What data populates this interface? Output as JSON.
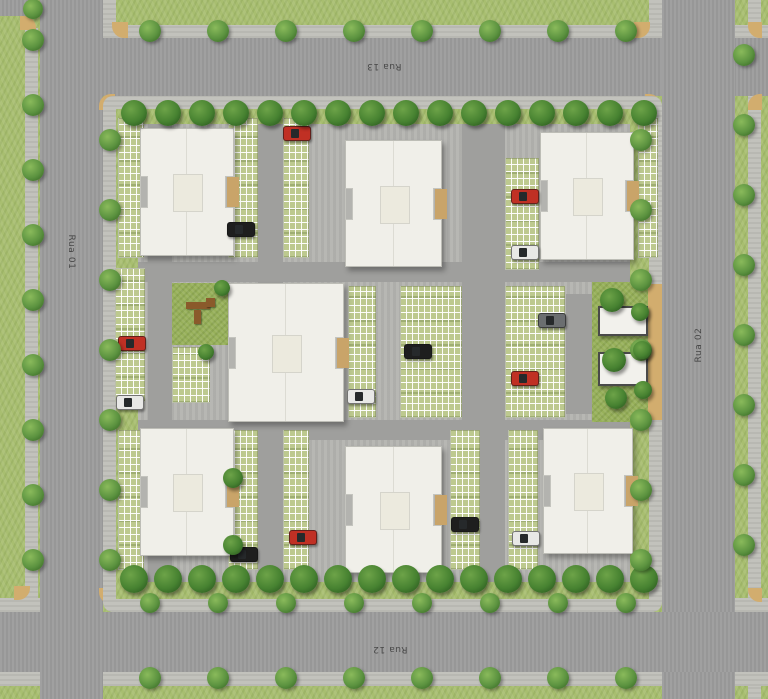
{
  "canvas": {
    "width": 768,
    "height": 699
  },
  "palette": {
    "grass": "#a8be70",
    "asphalt": "#9c9c9c",
    "sidewalk": "#c2c2bc",
    "curb_tan": "#d2ad6e",
    "building": "#f0efe9",
    "parking_green": "#bdc98f",
    "tree_dark": "#2f5f22",
    "tree_light": "#5c9340",
    "car_red": "#c03024",
    "car_black": "#1e1e1e",
    "car_white": "#e8e8e6",
    "car_gray": "#6b6e70"
  },
  "street_labels": [
    {
      "text": "Rua 13",
      "x": 384,
      "y": 66,
      "rot": 180
    },
    {
      "text": "Rua 12",
      "x": 390,
      "y": 649,
      "rot": 180
    },
    {
      "text": "Rua 01",
      "x": 71,
      "y": 252,
      "rot": 90
    },
    {
      "text": "Rua 02",
      "x": 699,
      "y": 345,
      "rot": -90
    }
  ],
  "ground": [
    {
      "name": "grass-base",
      "cls": "grass",
      "x": 0,
      "y": 0,
      "w": 768,
      "h": 699
    },
    {
      "name": "sidewalk-west-verge",
      "cls": "walk",
      "x": 25,
      "y": 28,
      "w": 13,
      "h": 570
    },
    {
      "name": "sidewalk-far-east",
      "cls": "walk",
      "x": 748,
      "y": 0,
      "w": 13,
      "h": 699
    },
    {
      "name": "sidewalk-rua13-north",
      "cls": "walk",
      "x": 40,
      "y": 25,
      "w": 728,
      "h": 13
    },
    {
      "name": "sidewalk-rua02-top",
      "cls": "walk",
      "x": 649,
      "y": 0,
      "w": 13,
      "h": 25
    },
    {
      "name": "sidewalk-rua01-top",
      "cls": "walk",
      "x": 103,
      "y": 0,
      "w": 13,
      "h": 25
    },
    {
      "name": "sidewalk-rua12-south",
      "cls": "walk",
      "x": 0,
      "y": 672,
      "w": 768,
      "h": 14
    },
    {
      "name": "sidewalk-rua12-north-w",
      "cls": "walk",
      "x": 0,
      "y": 598,
      "w": 40,
      "h": 14
    },
    {
      "name": "sidewalk-rua12-north-e",
      "cls": "walk",
      "x": 735,
      "y": 598,
      "w": 33,
      "h": 14
    },
    {
      "name": "road-rua-13",
      "cls": "road",
      "x": 40,
      "y": 38,
      "w": 728,
      "h": 58
    },
    {
      "name": "road-rua-01",
      "cls": "road",
      "x": 40,
      "y": 0,
      "w": 63,
      "h": 699
    },
    {
      "name": "road-rua-02",
      "cls": "road",
      "x": 662,
      "y": 0,
      "w": 73,
      "h": 699
    },
    {
      "name": "road-rua-12",
      "cls": "road",
      "x": 0,
      "y": 612,
      "w": 768,
      "h": 60
    },
    {
      "name": "road-stub-top-left",
      "cls": "road",
      "x": 0,
      "y": 0,
      "w": 34,
      "h": 16
    },
    {
      "name": "curb-corner",
      "cls": "tan",
      "x": 99,
      "y": 94,
      "w": 16,
      "h": 16,
      "br": "12px 0 0 0"
    },
    {
      "name": "curb-corner",
      "cls": "tan",
      "x": 645,
      "y": 94,
      "w": 16,
      "h": 16,
      "br": "0 12px 0 0"
    },
    {
      "name": "curb-corner",
      "cls": "tan",
      "x": 99,
      "y": 588,
      "w": 16,
      "h": 16,
      "br": "0 0 0 12px"
    },
    {
      "name": "curb-corner",
      "cls": "tan",
      "x": 645,
      "y": 588,
      "w": 16,
      "h": 16,
      "br": "0 0 12px 0"
    },
    {
      "name": "curb-corner",
      "cls": "tan",
      "x": 112,
      "y": 22,
      "w": 16,
      "h": 16,
      "br": "0 0 0 12px"
    },
    {
      "name": "curb-corner",
      "cls": "tan",
      "x": 634,
      "y": 22,
      "w": 16,
      "h": 16,
      "br": "0 0 12px 0"
    },
    {
      "name": "curb-corner",
      "cls": "tan",
      "x": 748,
      "y": 22,
      "w": 14,
      "h": 16,
      "br": "0 0 0 12px"
    },
    {
      "name": "curb-corner",
      "cls": "tan",
      "x": 748,
      "y": 94,
      "w": 14,
      "h": 16,
      "br": "12px 0 0 0"
    },
    {
      "name": "curb-corner",
      "cls": "tan",
      "x": 20,
      "y": 16,
      "w": 16,
      "h": 14,
      "br": "0 12px 0 0"
    },
    {
      "name": "curb-corner",
      "cls": "tan",
      "x": 14,
      "y": 586,
      "w": 16,
      "h": 14,
      "br": "0 0 12px 0"
    },
    {
      "name": "curb-corner",
      "cls": "tan",
      "x": 748,
      "y": 588,
      "w": 14,
      "h": 14,
      "br": "0 0 0 12px"
    },
    {
      "name": "block-sidewalk-ring",
      "cls": "walk",
      "x": 103,
      "y": 96,
      "w": 559,
      "h": 516,
      "br": "10px"
    },
    {
      "name": "block-lawn-ring",
      "cls": "lawn",
      "x": 116,
      "y": 109,
      "w": 533,
      "h": 490
    },
    {
      "name": "block-interior-paving",
      "cls": "pave",
      "x": 138,
      "y": 124,
      "w": 492,
      "h": 458
    },
    {
      "name": "internal-road-north",
      "cls": "iroad",
      "x": 138,
      "y": 262,
      "w": 492,
      "h": 20
    },
    {
      "name": "internal-road-south",
      "cls": "iroad",
      "x": 138,
      "y": 420,
      "w": 492,
      "h": 20
    },
    {
      "name": "internal-road-west",
      "cls": "iroad",
      "x": 148,
      "y": 124,
      "w": 24,
      "h": 458
    },
    {
      "name": "internal-road-mid-left",
      "cls": "iroad",
      "x": 258,
      "y": 124,
      "w": 25,
      "h": 458
    },
    {
      "name": "internal-road-mid-right",
      "cls": "iroad",
      "x": 462,
      "y": 124,
      "w": 43,
      "h": 458
    },
    {
      "name": "entrance-lane-in",
      "cls": "iroad",
      "x": 570,
      "y": 294,
      "w": 78,
      "h": 26
    },
    {
      "name": "entrance-lane-out",
      "cls": "iroad",
      "x": 570,
      "y": 388,
      "w": 78,
      "h": 26
    },
    {
      "name": "entrance-lane-link",
      "cls": "iroad",
      "x": 566,
      "y": 294,
      "w": 26,
      "h": 120
    },
    {
      "name": "entrance-driveway-tan",
      "cls": "tan",
      "x": 646,
      "y": 284,
      "w": 16,
      "h": 136
    },
    {
      "name": "entrance-lawn",
      "cls": "lawn2",
      "x": 592,
      "y": 282,
      "w": 56,
      "h": 140
    },
    {
      "name": "playground-lawn",
      "cls": "lawn2",
      "x": 172,
      "y": 283,
      "w": 56,
      "h": 62
    },
    {
      "name": "playground-equipment",
      "cls": "equip",
      "x": 186,
      "y": 302,
      "w": 24,
      "h": 7
    },
    {
      "name": "playground-equipment",
      "cls": "equip",
      "x": 194,
      "y": 310,
      "w": 7,
      "h": 14
    },
    {
      "name": "playground-equipment",
      "cls": "equip",
      "x": 206,
      "y": 298,
      "w": 9,
      "h": 9
    },
    {
      "name": "hedge",
      "cls": "hedge",
      "x": 230,
      "y": 334,
      "w": 11,
      "h": 13
    },
    {
      "name": "hedge",
      "cls": "hedge",
      "x": 345,
      "y": 338,
      "w": 8,
      "h": 12
    }
  ],
  "parking_lots": [
    {
      "x": 118,
      "y": 118,
      "w": 26,
      "h": 140
    },
    {
      "x": 228,
      "y": 118,
      "w": 30,
      "h": 140
    },
    {
      "x": 283,
      "y": 118,
      "w": 26,
      "h": 140
    },
    {
      "x": 505,
      "y": 158,
      "w": 34,
      "h": 112
    },
    {
      "x": 638,
      "y": 118,
      "w": 20,
      "h": 140
    },
    {
      "x": 115,
      "y": 268,
      "w": 30,
      "h": 134
    },
    {
      "x": 172,
      "y": 347,
      "w": 38,
      "h": 56
    },
    {
      "x": 348,
      "y": 286,
      "w": 28,
      "h": 132
    },
    {
      "x": 400,
      "y": 286,
      "w": 62,
      "h": 132
    },
    {
      "x": 505,
      "y": 286,
      "w": 60,
      "h": 132
    },
    {
      "x": 118,
      "y": 430,
      "w": 26,
      "h": 140
    },
    {
      "x": 228,
      "y": 430,
      "w": 30,
      "h": 140
    },
    {
      "x": 283,
      "y": 430,
      "w": 26,
      "h": 140
    },
    {
      "x": 450,
      "y": 430,
      "w": 30,
      "h": 140
    },
    {
      "x": 508,
      "y": 430,
      "w": 30,
      "h": 140
    }
  ],
  "buildings": [
    {
      "name": "building-top-left",
      "x": 140,
      "y": 128,
      "w": 92,
      "h": 126
    },
    {
      "name": "building-top-center",
      "x": 345,
      "y": 140,
      "w": 95,
      "h": 125
    },
    {
      "name": "building-top-right",
      "x": 540,
      "y": 132,
      "w": 92,
      "h": 126
    },
    {
      "name": "building-center",
      "x": 228,
      "y": 283,
      "w": 114,
      "h": 137
    },
    {
      "name": "building-bottom-left",
      "x": 140,
      "y": 428,
      "w": 92,
      "h": 126
    },
    {
      "name": "building-bottom-center",
      "x": 345,
      "y": 446,
      "w": 95,
      "h": 125
    },
    {
      "name": "building-bottom-right",
      "x": 543,
      "y": 428,
      "w": 88,
      "h": 124
    }
  ],
  "structures": [
    {
      "name": "gatehouse",
      "x": 598,
      "y": 306,
      "w": 46,
      "h": 26
    },
    {
      "name": "gate-carport",
      "x": 598,
      "y": 352,
      "w": 46,
      "h": 30
    }
  ],
  "cars": [
    {
      "x": 283,
      "y": 126,
      "color": "#c03024"
    },
    {
      "x": 227,
      "y": 222,
      "color": "#1e1e1e"
    },
    {
      "x": 511,
      "y": 189,
      "color": "#c03024"
    },
    {
      "x": 511,
      "y": 245,
      "color": "#e8e8e6"
    },
    {
      "x": 118,
      "y": 336,
      "color": "#c03024"
    },
    {
      "x": 116,
      "y": 395,
      "color": "#e8e8e6"
    },
    {
      "x": 347,
      "y": 389,
      "color": "#e8e8e6"
    },
    {
      "x": 404,
      "y": 344,
      "color": "#1e1e1e"
    },
    {
      "x": 538,
      "y": 313,
      "color": "#6b6e70"
    },
    {
      "x": 511,
      "y": 371,
      "color": "#c03024"
    },
    {
      "x": 289,
      "y": 530,
      "color": "#c03024"
    },
    {
      "x": 230,
      "y": 547,
      "color": "#1e1e1e"
    },
    {
      "x": 451,
      "y": 517,
      "color": "#1e1e1e"
    },
    {
      "x": 512,
      "y": 531,
      "color": "#e8e8e6"
    }
  ],
  "tree_rows": [
    {
      "x": 150,
      "y": 31,
      "dx": 68,
      "dy": 0,
      "n": 8,
      "r": 11,
      "kind": "street"
    },
    {
      "x": 33,
      "y": 9,
      "dx": 0,
      "dy": 0,
      "n": 1,
      "r": 10,
      "kind": "street"
    },
    {
      "x": 134,
      "y": 113,
      "dx": 34,
      "dy": 0,
      "n": 16,
      "r": 13,
      "kind": "dense"
    },
    {
      "x": 134,
      "y": 579,
      "dx": 34,
      "dy": 0,
      "n": 16,
      "r": 14,
      "kind": "dense"
    },
    {
      "x": 150,
      "y": 603,
      "dx": 68,
      "dy": 0,
      "n": 8,
      "r": 10,
      "kind": "street"
    },
    {
      "x": 150,
      "y": 678,
      "dx": 68,
      "dy": 0,
      "n": 8,
      "r": 11,
      "kind": "street"
    },
    {
      "x": 33,
      "y": 40,
      "dx": 0,
      "dy": 65,
      "n": 9,
      "r": 11,
      "kind": "street"
    },
    {
      "x": 110,
      "y": 140,
      "dx": 0,
      "dy": 70,
      "n": 7,
      "r": 11,
      "kind": "street"
    },
    {
      "x": 641,
      "y": 140,
      "dx": 0,
      "dy": 70,
      "n": 7,
      "r": 11,
      "kind": "street"
    },
    {
      "x": 744,
      "y": 55,
      "dx": 0,
      "dy": 70,
      "n": 8,
      "r": 11,
      "kind": "street"
    }
  ],
  "single_trees": [
    {
      "x": 612,
      "y": 300,
      "r": 12,
      "kind": "dense"
    },
    {
      "x": 640,
      "y": 312,
      "r": 9,
      "kind": "dense"
    },
    {
      "x": 614,
      "y": 360,
      "r": 12,
      "kind": "dense"
    },
    {
      "x": 642,
      "y": 350,
      "r": 9,
      "kind": "dense"
    },
    {
      "x": 616,
      "y": 398,
      "r": 11,
      "kind": "dense"
    },
    {
      "x": 643,
      "y": 390,
      "r": 9,
      "kind": "dense"
    },
    {
      "x": 222,
      "y": 288,
      "r": 8,
      "kind": "dense"
    },
    {
      "x": 233,
      "y": 478,
      "r": 10,
      "kind": "dense"
    },
    {
      "x": 233,
      "y": 545,
      "r": 10,
      "kind": "dense"
    },
    {
      "x": 206,
      "y": 352,
      "r": 8,
      "kind": "dense"
    }
  ]
}
